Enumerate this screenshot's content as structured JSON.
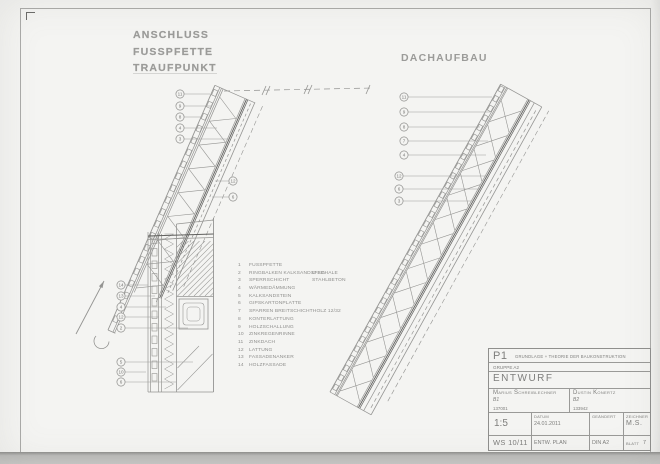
{
  "titles": {
    "left_line1": "ANSCHLUSS",
    "left_line2": "FUSSPFETTE",
    "left_line3": "TRAUFPUNKT",
    "right": "DACHAUFBAU"
  },
  "legend": {
    "items": [
      {
        "no": "1",
        "label": "FUSSPFETTE",
        "note": ""
      },
      {
        "no": "2",
        "label": "RINGBALKEN KALKSANDSTEIN",
        "note": "U-SCHALE"
      },
      {
        "no": "3",
        "label": "SPERRSCHICHT",
        "note": "STAHLBETON"
      },
      {
        "no": "4",
        "label": "WÄRMEDÄMMUNG",
        "note": ""
      },
      {
        "no": "5",
        "label": "KALKSANDSTEIN",
        "note": ""
      },
      {
        "no": "6",
        "label": "GIPSKARTONPLATTE",
        "note": ""
      },
      {
        "no": "7",
        "label": "SPARREN BREITSCHICHTHOLZ 12/32",
        "note": ""
      },
      {
        "no": "8",
        "label": "KONTERLATTUNG",
        "note": ""
      },
      {
        "no": "9",
        "label": "HOLZSCHALLUNG",
        "note": ""
      },
      {
        "no": "10",
        "label": "ZINKREGENRINNE",
        "note": ""
      },
      {
        "no": "11",
        "label": "ZINKDACH",
        "note": ""
      },
      {
        "no": "12",
        "label": "LATTUNG",
        "note": ""
      },
      {
        "no": "13",
        "label": "FASSADENANKER",
        "note": ""
      },
      {
        "no": "14",
        "label": "HOLZFASSADE",
        "note": ""
      }
    ]
  },
  "drawings": {
    "left": {
      "callouts": [
        {
          "n": "11",
          "x": 180,
          "y": 94,
          "ex": 210
        },
        {
          "n": "9",
          "x": 180,
          "y": 106,
          "ex": 212
        },
        {
          "n": "8",
          "x": 180,
          "y": 117,
          "ex": 202
        },
        {
          "n": "4",
          "x": 180,
          "y": 128,
          "ex": 217
        },
        {
          "n": "3",
          "x": 180,
          "y": 139,
          "ex": 230
        },
        {
          "n": "12",
          "x": 233,
          "y": 181,
          "ex": 215
        },
        {
          "n": "6",
          "x": 233,
          "y": 197,
          "ex": 212
        },
        {
          "n": "14",
          "x": 121,
          "y": 285,
          "ex": 148
        },
        {
          "n": "13",
          "x": 121,
          "y": 296,
          "ex": 155
        },
        {
          "n": "4",
          "x": 121,
          "y": 307,
          "ex": 166
        },
        {
          "n": "12",
          "x": 121,
          "y": 317,
          "ex": 159
        },
        {
          "n": "2",
          "x": 121,
          "y": 328,
          "ex": 188
        },
        {
          "n": "5",
          "x": 121,
          "y": 362,
          "ex": 193
        },
        {
          "n": "10",
          "x": 121,
          "y": 372,
          "ex": 146
        },
        {
          "n": "6",
          "x": 121,
          "y": 382,
          "ex": 176
        }
      ]
    },
    "right": {
      "callouts": [
        {
          "n": "11",
          "x": 404,
          "y": 97,
          "ex": 492
        },
        {
          "n": "9",
          "x": 404,
          "y": 112,
          "ex": 490
        },
        {
          "n": "8",
          "x": 404,
          "y": 127,
          "ex": 480
        },
        {
          "n": "7",
          "x": 404,
          "y": 141,
          "ex": 488
        },
        {
          "n": "4",
          "x": 404,
          "y": 155,
          "ex": 486
        },
        {
          "n": "12",
          "x": 399,
          "y": 176,
          "ex": 487
        },
        {
          "n": "6",
          "x": 399,
          "y": 189,
          "ex": 482
        },
        {
          "n": "3",
          "x": 399,
          "y": 201,
          "ex": 473
        }
      ]
    }
  },
  "titleblock": {
    "project_code": "P1",
    "project_title": "GRUNDLAGE + THEORIE DER BAUKONSTRUKTION",
    "group": "GRUPPE A2",
    "phase": "ENTWURF",
    "authors": [
      {
        "name": "Marius Schreiblechner",
        "id": "B1",
        "matric": "137001"
      },
      {
        "name": "Dustin Konertz",
        "id": "B2",
        "matric": "133942"
      }
    ],
    "scale": "1:5",
    "date_label": "DATUM",
    "date": "24.01.2011",
    "changed_label": "GEÄNDERT",
    "drafter_label": "ZEICHNER",
    "drafter": "M.S.",
    "semester": "WS 10/11",
    "plan_type": "ENTW. PLAN",
    "format": "DIN A2",
    "sheet_label": "BLATT",
    "sheet_no": "7"
  }
}
